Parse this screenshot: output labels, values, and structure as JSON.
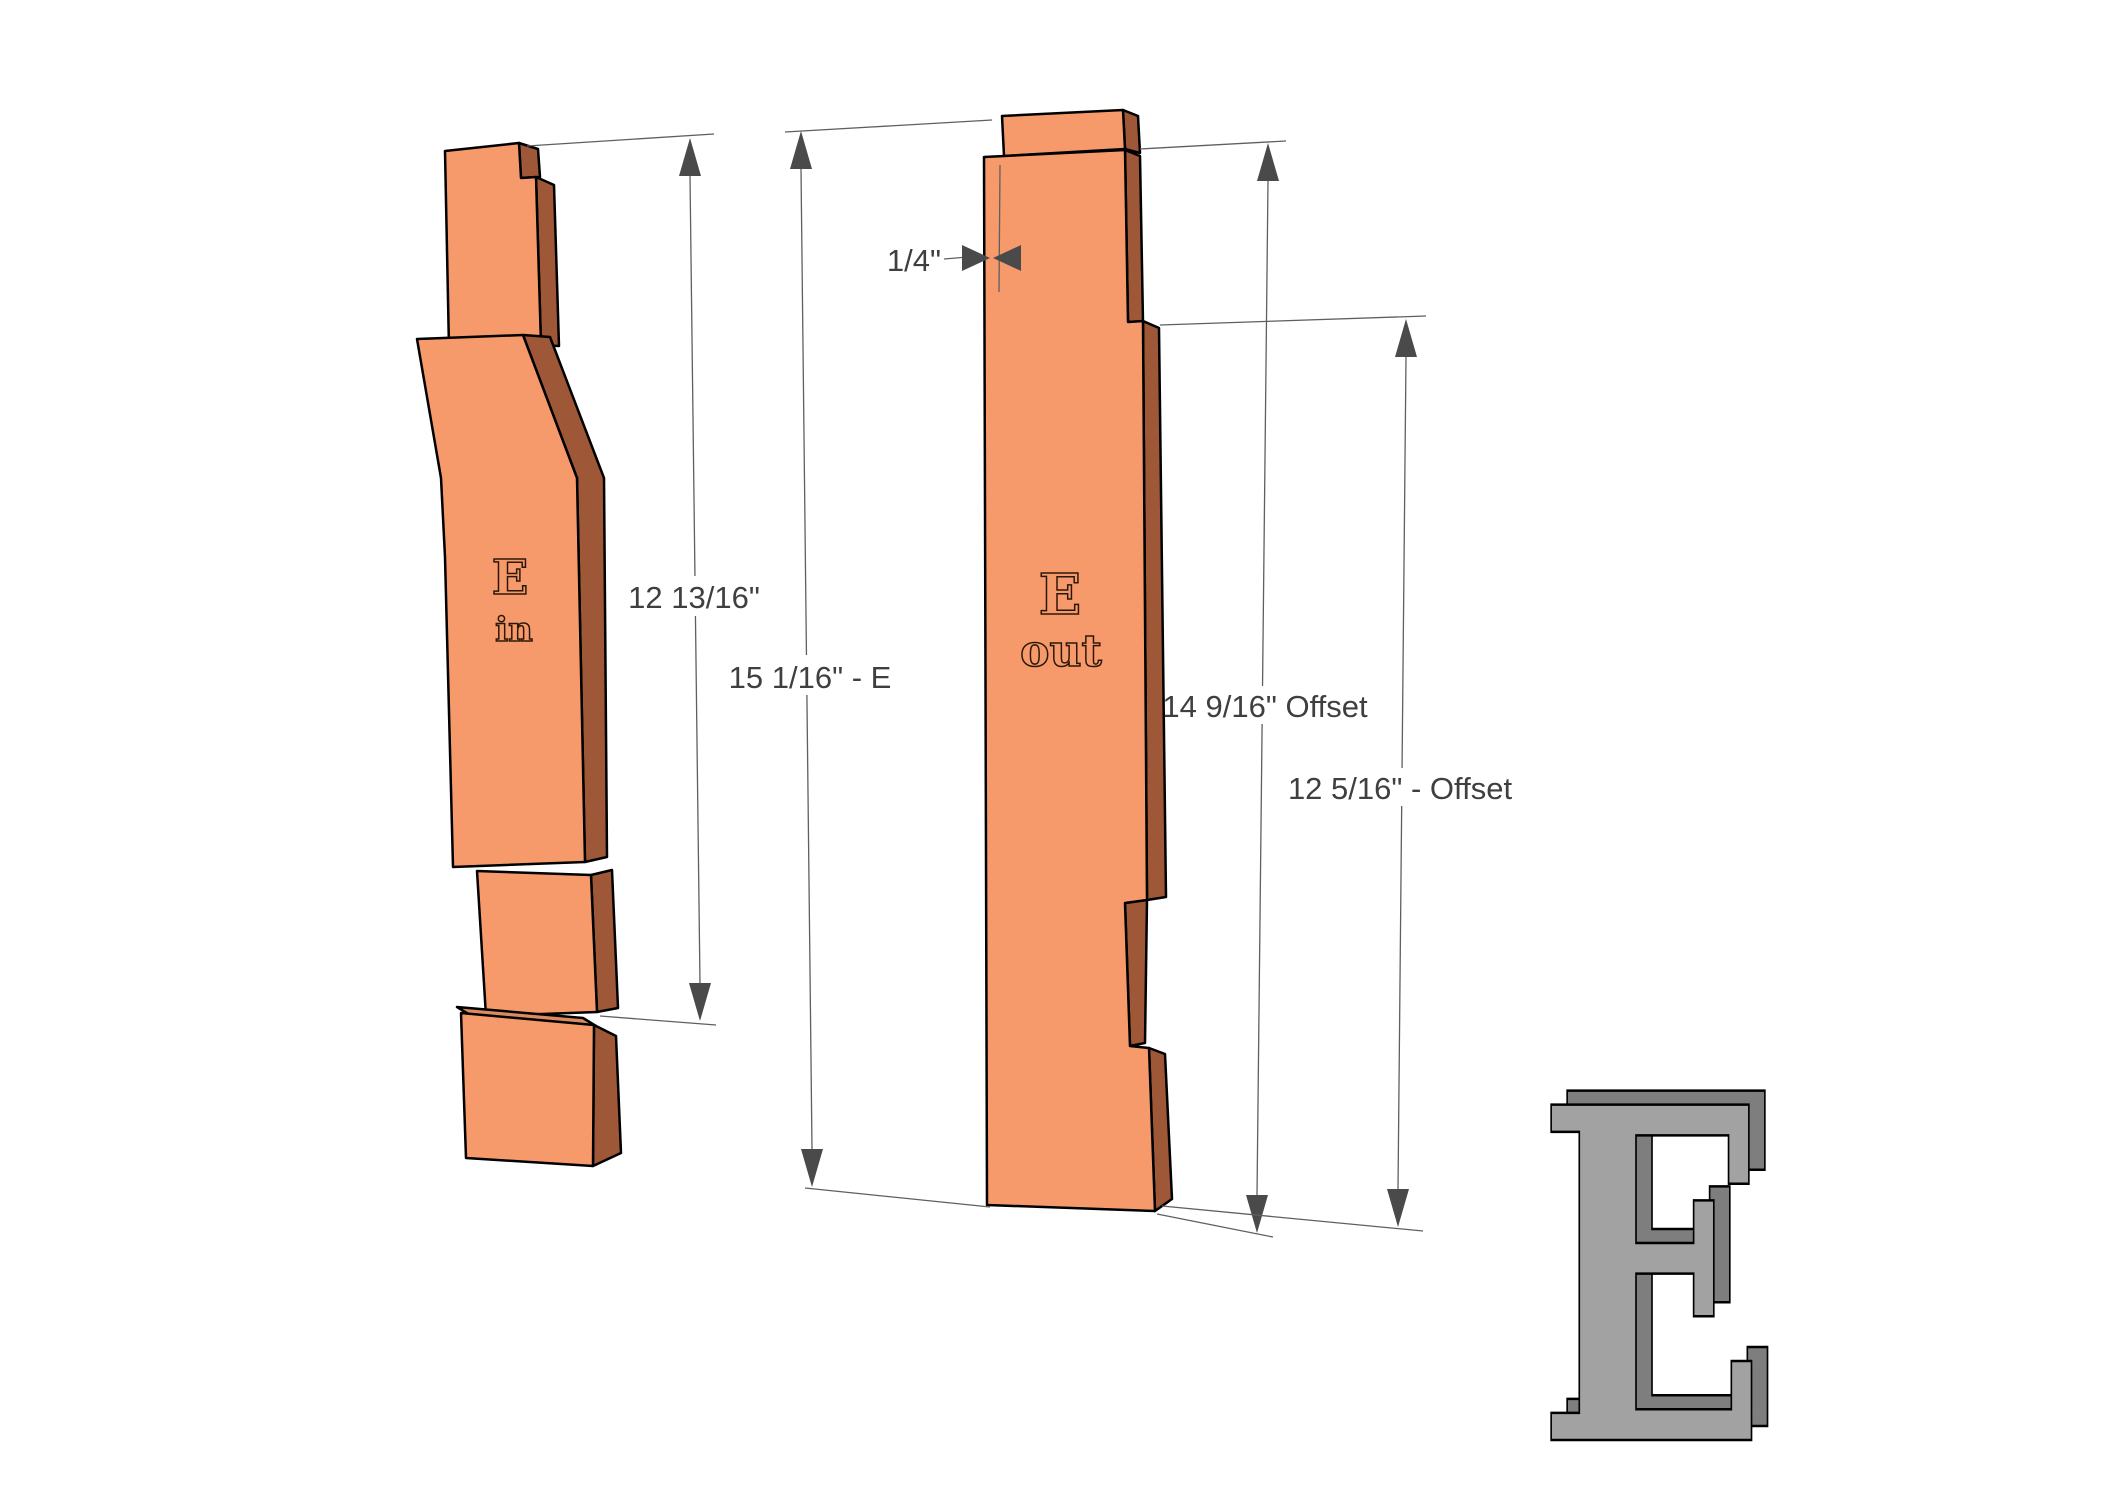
{
  "scene": {
    "background_color": "#ffffff",
    "dimension_line_color": "#5f5f5f",
    "arrow_color": "#4a4a4a",
    "dimension_text_color": "#3f3f3f",
    "outline_color": "#000000"
  },
  "parts": {
    "part_in": {
      "engraving_letter": "E",
      "engraving_word": "in",
      "face_color": "#F69A6C",
      "side_color": "#9E5737",
      "top_color": "#DD8A5F"
    },
    "part_out": {
      "engraving_letter": "E",
      "engraving_word": "out",
      "face_color": "#F69A6C",
      "side_color": "#9E5737"
    },
    "letter_3d": {
      "glyph": "E",
      "face_color": "#A2A2A2",
      "depth_color": "#7E7E7E"
    }
  },
  "dimensions": {
    "part_in_height": {
      "label": "12 13/16\""
    },
    "part_out_total_height": {
      "label": "15 1/16\" - E"
    },
    "offset_upper": {
      "label": "14 9/16\" Offset"
    },
    "offset_lower": {
      "label": "12 5/16\" - Offset"
    },
    "tab_inset": {
      "label": "1/4\""
    }
  }
}
